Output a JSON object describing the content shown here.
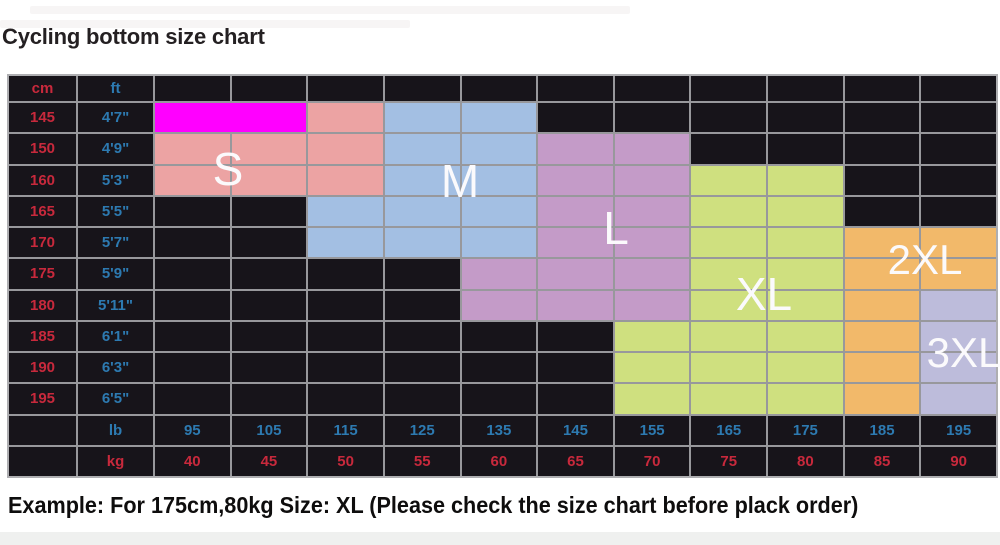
{
  "page": {
    "title": "Cycling bottom size chart",
    "example_note": "Example: For 175cm,80kg Size: XL (Please check the size chart before plack order)"
  },
  "colors": {
    "highlight_magenta": "#ff00ff",
    "size_s_pink": "#eca3a3",
    "size_m_blue": "#a3bfe3",
    "size_l_purple": "#c49bc8",
    "size_xl_yellow": "#cfe07f",
    "size_2xl_orange": "#f2b96a",
    "size_3xl_violet": "#bdbcdb",
    "table_background": "#17141a",
    "grid_line": "#98989c",
    "cm_kg_red": "#c8293c",
    "ft_lb_blue": "#2d7ab1",
    "size_label_white": "#fbfafc"
  },
  "chart_data": {
    "type": "heatmap",
    "title": "Cycling bottom size chart",
    "column_headers": {
      "height_cm": "cm",
      "height_ft": "ft"
    },
    "footer_row_labels": {
      "weight_lb": "lb",
      "weight_kg": "kg"
    },
    "weight_lb": [
      "95",
      "105",
      "115",
      "125",
      "135",
      "145",
      "155",
      "165",
      "175",
      "185",
      "195"
    ],
    "weight_kg": [
      "40",
      "45",
      "50",
      "55",
      "60",
      "65",
      "70",
      "75",
      "80",
      "85",
      "90"
    ],
    "size_labels": {
      "s": "S",
      "m": "M",
      "l": "L",
      "xl": "XL",
      "xxl": "2XL",
      "xxxl": "3XL"
    },
    "legend": {
      "HL": "magenta highlight bar",
      "S": "size S region",
      "M": "size M region",
      "L": "size L region",
      "XL": "size XL region",
      "2XL": "size 2XL region",
      "3XL": "size 3XL region",
      "": "empty black cell"
    },
    "rows": [
      {
        "cm": "145",
        "ft": "4'7\"",
        "cells": [
          "HL",
          "HL",
          "S",
          "M",
          "M",
          "",
          "",
          "",
          "",
          "",
          ""
        ]
      },
      {
        "cm": "150",
        "ft": "4'9\"",
        "cells": [
          "S",
          "S",
          "S",
          "M",
          "M",
          "L",
          "L",
          "",
          "",
          "",
          ""
        ]
      },
      {
        "cm": "160",
        "ft": "5'3\"",
        "cells": [
          "S",
          "S",
          "S",
          "M",
          "M",
          "L",
          "L",
          "XL",
          "XL",
          "",
          ""
        ]
      },
      {
        "cm": "165",
        "ft": "5'5\"",
        "cells": [
          "",
          "",
          "M",
          "M",
          "M",
          "L",
          "L",
          "XL",
          "XL",
          "",
          ""
        ]
      },
      {
        "cm": "170",
        "ft": "5'7\"",
        "cells": [
          "",
          "",
          "M",
          "M",
          "M",
          "L",
          "L",
          "XL",
          "XL",
          "2XL",
          "2XL"
        ]
      },
      {
        "cm": "175",
        "ft": "5'9\"",
        "cells": [
          "",
          "",
          "",
          "",
          "L",
          "L",
          "L",
          "XL",
          "XL",
          "2XL",
          "2XL"
        ]
      },
      {
        "cm": "180",
        "ft": "5'11\"",
        "cells": [
          "",
          "",
          "",
          "",
          "L",
          "L",
          "L",
          "XL",
          "XL",
          "2XL",
          "3XL"
        ]
      },
      {
        "cm": "185",
        "ft": "6'1\"",
        "cells": [
          "",
          "",
          "",
          "",
          "",
          "",
          "XL",
          "XL",
          "XL",
          "2XL",
          "3XL"
        ]
      },
      {
        "cm": "190",
        "ft": "6'3\"",
        "cells": [
          "",
          "",
          "",
          "",
          "",
          "",
          "XL",
          "XL",
          "XL",
          "2XL",
          "3XL"
        ]
      },
      {
        "cm": "195",
        "ft": "6'5\"",
        "cells": [
          "",
          "",
          "",
          "",
          "",
          "",
          "XL",
          "XL",
          "XL",
          "2XL",
          "3XL"
        ]
      }
    ]
  }
}
